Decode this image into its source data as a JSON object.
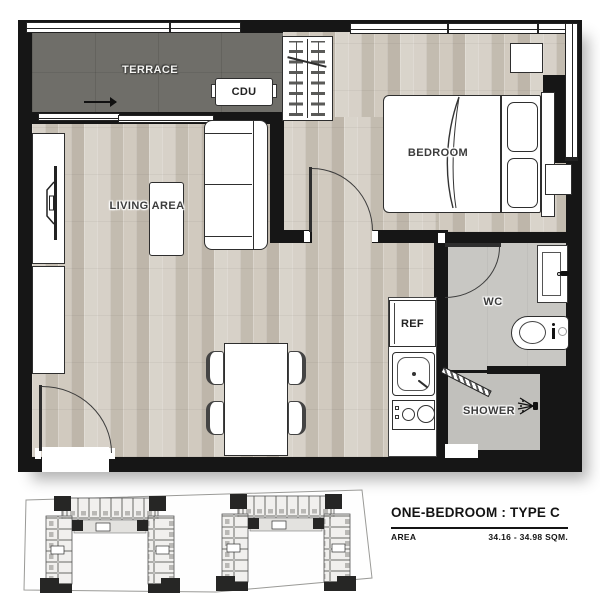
{
  "plan": {
    "labels": {
      "terrace": "TERRACE",
      "cdu": "CDU",
      "living_area": "LIVING AREA",
      "bedroom": "BEDROOM",
      "wc": "WC",
      "ref": "REF",
      "shower": "SHOWER"
    }
  },
  "footer": {
    "title": "ONE-BEDROOM : TYPE C",
    "area_label": "AREA",
    "area_value": "34.16 - 34.98 SQM."
  },
  "icons": {
    "tv": "tv-icon",
    "shower_head": "shower-head-icon",
    "sink_faucet": "faucet-icon",
    "vanity_faucet": "faucet-icon",
    "flow_arrow": "flow-arrow-icon"
  },
  "colors": {
    "wall": "#161616",
    "terrace_floor": "#6f6e69",
    "wood_floor": "#cfc8be",
    "wet_floor": "#c8c7c3",
    "shower_floor": "#c1c0bc"
  }
}
